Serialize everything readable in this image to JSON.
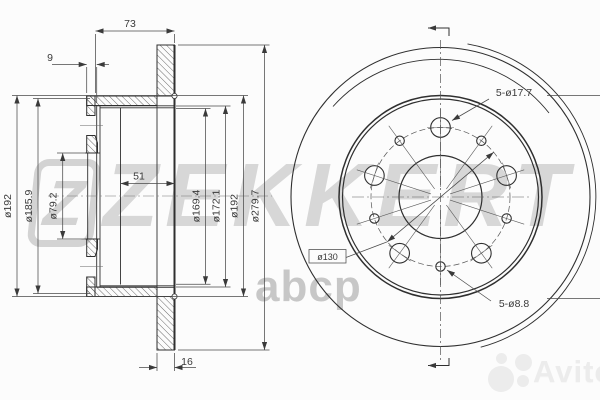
{
  "watermarks": {
    "brand_logo_letter": "Z",
    "brand_name": "ZEKKERT",
    "marketplace_small": "abcp",
    "marketplace_main": "Avito"
  },
  "section_view": {
    "width_total": "73",
    "flange_thickness": "9",
    "hat_depth": "51",
    "disc_thickness": "16",
    "dia_outer_left": "ø192",
    "dia_hat": "ø185.9",
    "dia_bore": "ø79.2",
    "dia_inner_1": "ø169.4",
    "dia_inner_2": "ø172.1",
    "dia_outer_right": "ø192",
    "dia_disc": "ø279.7"
  },
  "front_view": {
    "bolt_holes": "5-ø17.7",
    "bolt_circle": "ø130",
    "service_holes": "5-ø8.8"
  }
}
